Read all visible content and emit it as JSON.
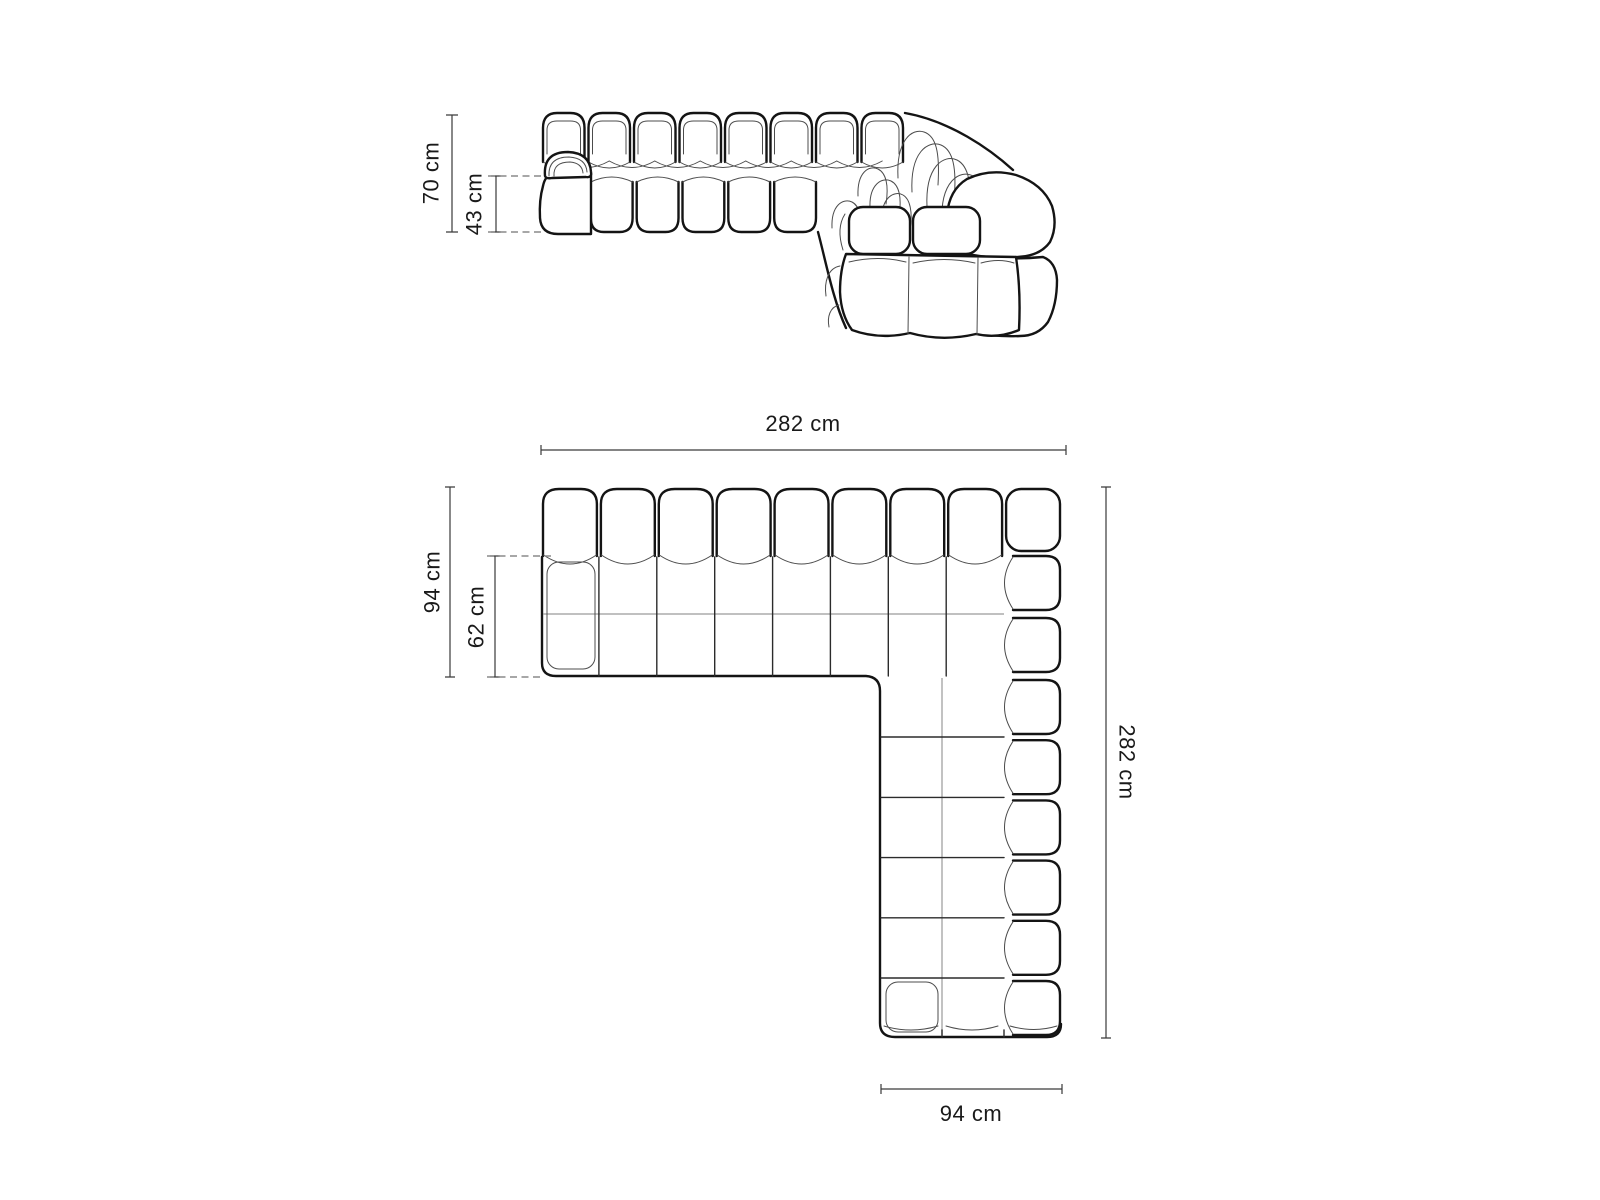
{
  "diagram": {
    "type": "furniture-dimension-drawing",
    "subject": "modular corner sofa, tufted bubble modules",
    "units": "cm",
    "front_view": {
      "name": "front-elevation",
      "total_height": {
        "label": "70 cm",
        "value": 70
      },
      "seat_height": {
        "label": "43 cm",
        "value": 43
      }
    },
    "top_view": {
      "name": "top-plan",
      "total_width": {
        "label": "282 cm",
        "value": 282
      },
      "total_depth": {
        "label": "94 cm",
        "value": 94
      },
      "seat_depth": {
        "label": "62 cm",
        "value": 62
      },
      "total_length": {
        "label": "282 cm",
        "value": 282
      },
      "chaise_width": {
        "label": "94 cm",
        "value": 94
      }
    },
    "colors": {
      "background": "#ffffff",
      "outline": "#141414",
      "thin_line": "#4c4c4c",
      "seam": "#9a9a9a",
      "dimension_line": "#3a3a3a",
      "text": "#1a1a1a"
    }
  }
}
